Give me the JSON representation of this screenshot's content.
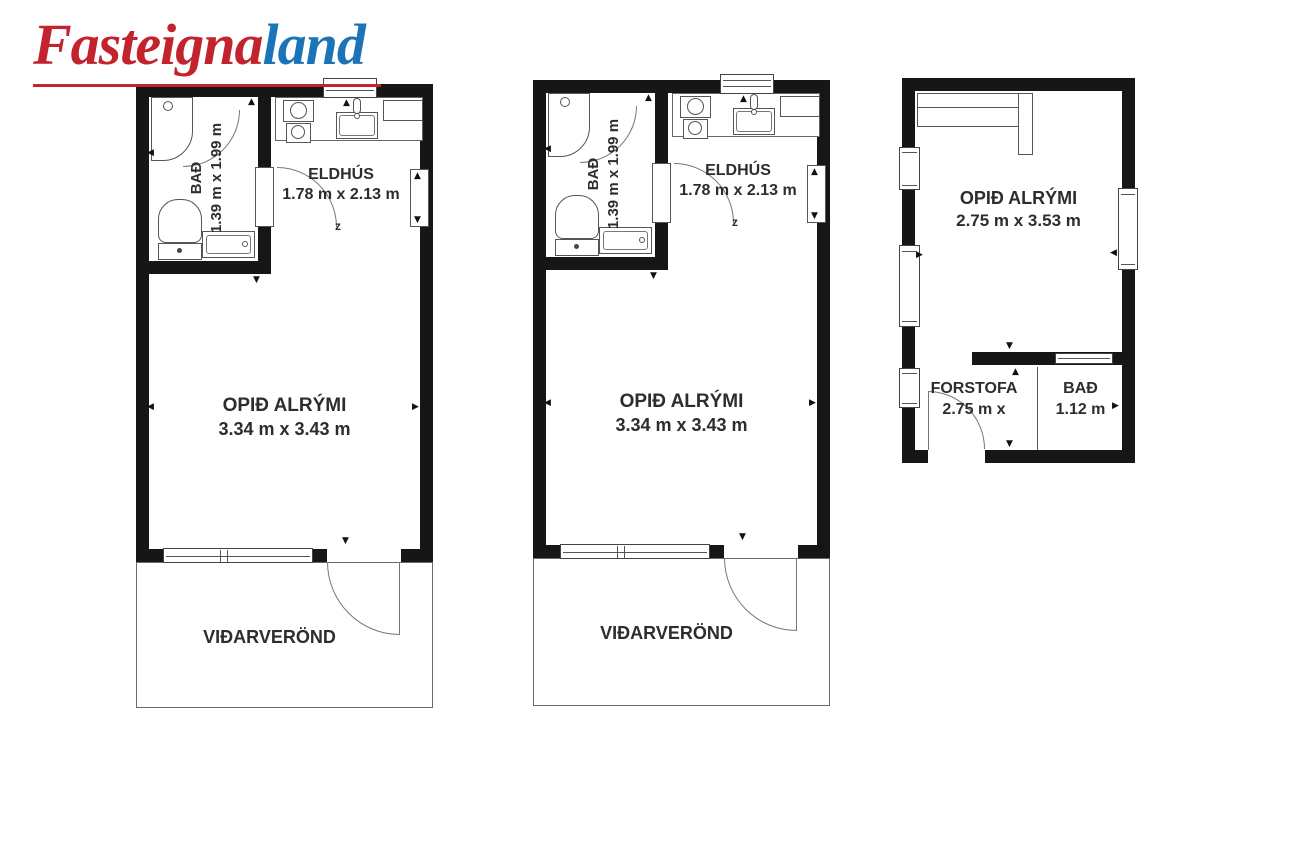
{
  "logo": {
    "text_red": "Fasteigna",
    "text_blue": "land",
    "color_red": "#c2232c",
    "color_blue": "#1b74b8"
  },
  "plans": {
    "unit1": {
      "bath_label": "BAÐ",
      "bath_dims": "1.39 m x 1.99 m",
      "kitchen_label": "ELDHÚS",
      "kitchen_dims": "1.78 m x 2.13 m",
      "room_label": "OPIÐ ALRÝMI",
      "room_dims": "3.34 m x 3.43 m",
      "deck_label": "VIÐARVERÖND",
      "drain_symbol": "z"
    },
    "unit2": {
      "bath_label": "BAÐ",
      "bath_dims": "1.39 m x 1.99 m",
      "kitchen_label": "ELDHÚS",
      "kitchen_dims": "1.78 m x 2.13 m",
      "room_label": "OPIÐ ALRÝMI",
      "room_dims": "3.34 m x 3.43 m",
      "deck_label": "VIÐARVERÖND",
      "drain_symbol": "z"
    },
    "unit3": {
      "room_label": "OPIÐ ALRÝMI",
      "room_dims": "2.75 m x 3.53 m",
      "hall_label": "FORSTOFA",
      "hall_dims": "2.75 m x",
      "bath_label": "BAÐ",
      "bath_dims": "1.12 m"
    }
  }
}
